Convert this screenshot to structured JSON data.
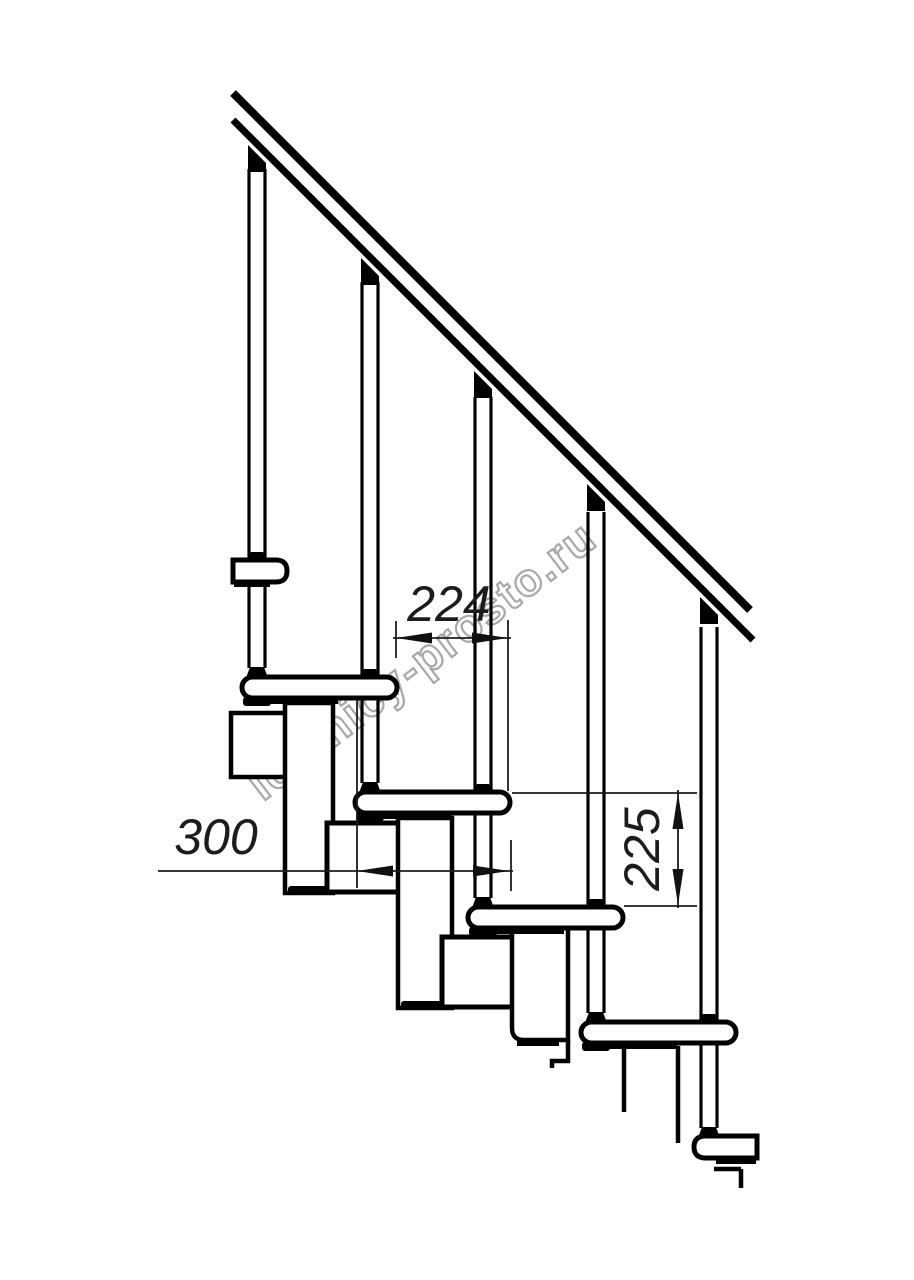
{
  "drawing": {
    "title": "Modular staircase side elevation drawing",
    "watermark": {
      "text": "lestnicy-prosto.ru",
      "color": "#a8a8a8"
    },
    "palette": {
      "background": "#ffffff",
      "structure_line": "#000000",
      "dimension_line": "#1c1c1c"
    },
    "dimensions": [
      {
        "id": "step-run",
        "value": "224",
        "orientation": "horizontal"
      },
      {
        "id": "tread-depth",
        "value": "300",
        "orientation": "horizontal"
      },
      {
        "id": "riser-height",
        "value": "225",
        "orientation": "vertical"
      }
    ],
    "elements": {
      "balusters": 5,
      "treads_visible": 6,
      "handrail": "diagonal double line, 45 degrees"
    }
  }
}
